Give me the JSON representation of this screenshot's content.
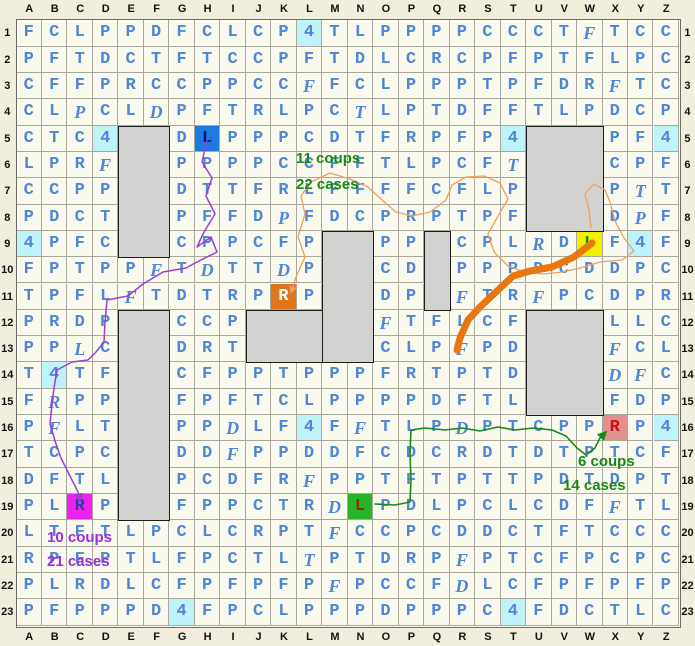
{
  "board": {
    "col_labels": [
      "A",
      "B",
      "C",
      "D",
      "E",
      "F",
      "G",
      "H",
      "I",
      "J",
      "K",
      "L",
      "M",
      "N",
      "O",
      "P",
      "Q",
      "R",
      "S",
      "T",
      "U",
      "V",
      "W",
      "X",
      "Y",
      "Z"
    ],
    "row_labels": [
      "1",
      "2",
      "3",
      "4",
      "5",
      "6",
      "7",
      "8",
      "9",
      "10",
      "11",
      "12",
      "13",
      "14",
      "15",
      "16",
      "17",
      "18",
      "19",
      "20",
      "21",
      "22",
      "23"
    ],
    "legend": "uppercase = upright letter, lowercase = italic letter, '.' = gray wall cell, '4' = cyan bonus cell",
    "rows": [
      "FCLPPDFCLCP4TLPPPPCCCTfTCC",
      "PFTDCTFTCCPFTDLCRCPFPTFLPC",
      "CFFPRCCPPCCfFCLPPPTPFDRfTC",
      "CLpCLdPFTRLPCtLPTDFFTLPDCP",
      "CTC4..DLPPPCDTFRPFP4...PF4",
      "LPRf..PPPPCCFFTLPCFt...CPF",
      "CCPP..DTTFRLFFFFCFLP...PtT",
      "PDCT..PFFDpFDCPRPTPF...DpF",
      "4PFC..CPPCFP..PP.CPLrDLF4F",
      "FPTPPfTdTTdP..CD.PPPDCDDPC",
      "TPFLfTDTRPRP..DP.fTRfPCDPR",
      "PRDP..CCP.....fTFLCF...LLC",
      "PPlC..DRT.....CLPfPD...fCL",
      "T4TF..CFPPTPPPFRTPTD...dfC",
      "FrPP..FPFTCLPPPPDFTL...FDP",
      "PfLT..PPdLF4FfTLPdPTCPPRP4",
      "TCPC..DDfPPDDFCDCRDTDTPTCF",
      "DFTL..PCDFRfPPTFTPTTPDTDPT",
      "PLRP..FPPCTRdLPDLPCLCDFfTL",
      "LTFTLPCLCRPTfCCPCDDCTFTCCC",
      "RPFPTLFPCTLtPTDRPfPTCFPCPC",
      "PLRDLCFPFPFPfPCCFdLCFPFPFP",
      "PFPPPD4FPCLPPPDPPPC4FDCTLC"
    ],
    "walls": [
      "E5:F9",
      "U5:W8",
      "M9:N13",
      "Q9:Q11",
      "J12:L13",
      "E12:F19",
      "U12:W15"
    ],
    "markers": [
      {
        "pos": "H5",
        "letter": "L",
        "bg": "#1e79e0",
        "fg": "#0a1f66",
        "name": "blue-start-L"
      },
      {
        "pos": "W9",
        "letter": "L",
        "bg": "#f2ef00",
        "fg": "#108a10",
        "name": "yellow-goal-L"
      },
      {
        "pos": "K11",
        "letter": "R",
        "bg": "#e0751c",
        "fg": "#ffffff",
        "name": "orange-start-R"
      },
      {
        "pos": "X16",
        "letter": "R",
        "bg": "#e59090",
        "fg": "#cc1111",
        "name": "red-goal-R"
      },
      {
        "pos": "N19",
        "letter": "L",
        "bg": "#28b428",
        "fg": "#8b3000",
        "name": "green-start-L"
      },
      {
        "pos": "C19",
        "letter": "R",
        "bg": "#ee22ee",
        "fg": "#2a3db0",
        "name": "magenta-goal-R"
      }
    ]
  },
  "annotations": [
    {
      "name": "orange-route-stats",
      "color": "#188818",
      "lines": [
        {
          "text": "11 coups",
          "x": 296,
          "y": 150
        },
        {
          "text": "22 cases",
          "x": 296,
          "y": 176
        }
      ]
    },
    {
      "name": "green-route-stats",
      "color": "#188818",
      "lines": [
        {
          "text": "6 coups",
          "x": 578,
          "y": 453
        },
        {
          "text": "14 cases",
          "x": 563,
          "y": 477
        }
      ]
    },
    {
      "name": "purple-route-stats",
      "color": "#9a2fd6",
      "lines": [
        {
          "text": "10 coups",
          "x": 47,
          "y": 529
        },
        {
          "text": "21 cases",
          "x": 47,
          "y": 553
        }
      ]
    }
  ],
  "paths": {
    "purple_route": {
      "color": "#9a3fd0",
      "width": 1.5,
      "arrow": true,
      "points": [
        [
          207,
          140
        ],
        [
          202,
          162
        ],
        [
          212,
          178
        ],
        [
          206,
          196
        ],
        [
          215,
          214
        ],
        [
          204,
          232
        ],
        [
          197,
          247
        ],
        [
          211,
          237
        ],
        [
          217,
          252
        ],
        [
          197,
          262
        ],
        [
          186,
          268
        ],
        [
          163,
          272
        ],
        [
          143,
          284
        ],
        [
          128,
          296
        ],
        [
          107,
          300
        ],
        [
          105,
          322
        ],
        [
          104,
          342
        ],
        [
          96,
          352
        ],
        [
          88,
          360
        ],
        [
          72,
          362
        ],
        [
          57,
          370
        ],
        [
          54,
          388
        ],
        [
          52,
          404
        ],
        [
          50,
          424
        ],
        [
          56,
          444
        ],
        [
          61,
          458
        ],
        [
          70,
          476
        ],
        [
          78,
          492
        ],
        [
          80,
          501
        ]
      ]
    },
    "orange_trace": {
      "color": "#eda05f",
      "width": 1.3,
      "arrow": true,
      "points": [
        [
          591,
          228
        ],
        [
          589,
          210
        ],
        [
          585,
          194
        ],
        [
          594,
          184
        ],
        [
          605,
          190
        ],
        [
          610,
          202
        ],
        [
          615,
          221
        ],
        [
          624,
          238
        ],
        [
          634,
          251
        ],
        [
          622,
          260
        ],
        [
          600,
          262
        ],
        [
          580,
          268
        ],
        [
          562,
          272
        ],
        [
          543,
          274
        ],
        [
          524,
          272
        ],
        [
          508,
          266
        ],
        [
          494,
          252
        ],
        [
          488,
          234
        ],
        [
          498,
          216
        ],
        [
          508,
          199
        ],
        [
          500,
          183
        ],
        [
          484,
          176
        ],
        [
          466,
          177
        ],
        [
          452,
          185
        ],
        [
          446,
          200
        ],
        [
          430,
          212
        ],
        [
          412,
          216
        ],
        [
          396,
          212
        ],
        [
          382,
          200
        ],
        [
          368,
          187
        ],
        [
          350,
          179
        ],
        [
          330,
          173
        ],
        [
          311,
          182
        ],
        [
          301,
          196
        ],
        [
          305,
          214
        ],
        [
          298,
          237
        ],
        [
          305,
          257
        ],
        [
          296,
          277
        ],
        [
          291,
          293
        ]
      ]
    },
    "orange_stroke": {
      "color": "#e87712",
      "width": 7,
      "arrow": false,
      "points": [
        [
          592,
          243
        ],
        [
          574,
          257
        ],
        [
          552,
          267
        ],
        [
          530,
          271
        ],
        [
          513,
          276
        ],
        [
          497,
          291
        ],
        [
          480,
          307
        ],
        [
          468,
          320
        ],
        [
          460,
          338
        ],
        [
          457,
          350
        ]
      ]
    },
    "green_route": {
      "color": "#188818",
      "width": 1.6,
      "arrow": true,
      "points": [
        [
          375,
          504
        ],
        [
          395,
          505
        ],
        [
          410,
          502
        ],
        [
          411,
          480
        ],
        [
          410,
          454
        ],
        [
          411,
          430
        ],
        [
          425,
          428
        ],
        [
          445,
          430
        ],
        [
          462,
          428
        ],
        [
          480,
          431
        ],
        [
          498,
          427
        ],
        [
          515,
          430
        ],
        [
          533,
          428
        ],
        [
          552,
          430
        ],
        [
          566,
          436
        ],
        [
          577,
          448
        ],
        [
          586,
          455
        ],
        [
          595,
          448
        ],
        [
          600,
          438
        ],
        [
          606,
          432
        ]
      ]
    }
  }
}
